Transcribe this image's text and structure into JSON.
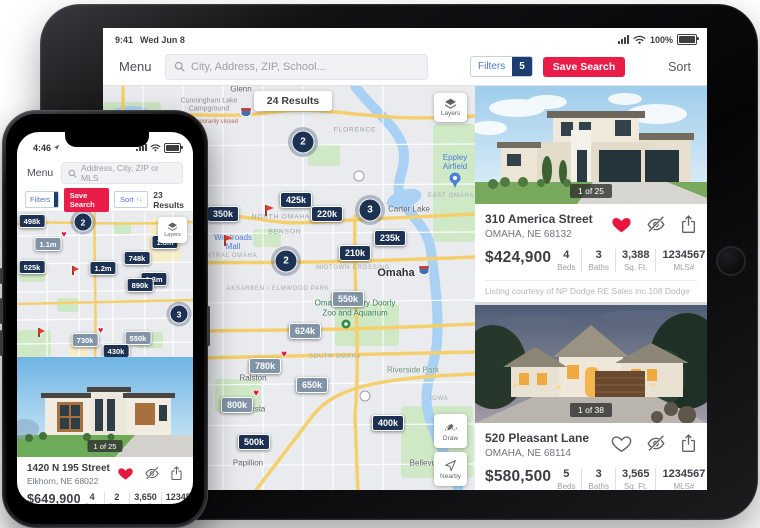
{
  "ipad": {
    "status": {
      "time": "9:41",
      "date": "Wed Jun 8",
      "battery": "100%"
    },
    "toolbar": {
      "menu": "Menu",
      "search_placeholder": "City, Address, ZIP, School...",
      "filters_label": "Filters",
      "filters_count": "5",
      "save_search_label": "Save Search",
      "sort_label": "Sort"
    },
    "map": {
      "results_badge": "24 Results",
      "layers_label": "Layers",
      "draw_label": "Draw",
      "nearby_label": "Nearby",
      "clusters": [
        {
          "count": "2",
          "x": 200,
          "y": 56
        },
        {
          "count": "3",
          "x": 267,
          "y": 124
        },
        {
          "count": "2",
          "x": 183,
          "y": 175
        }
      ],
      "pins": [
        {
          "value": "425k",
          "x": 193,
          "y": 114
        },
        {
          "value": "350k",
          "x": 120,
          "y": 128
        },
        {
          "value": "220k",
          "x": 224,
          "y": 128
        },
        {
          "value": "235k",
          "x": 287,
          "y": 152
        },
        {
          "value": "210k",
          "x": 252,
          "y": 167
        },
        {
          "value": "550k",
          "x": 245,
          "y": 213,
          "viewed": true
        },
        {
          "value": "624k",
          "x": 202,
          "y": 245,
          "viewed": true
        },
        {
          "value": "780k",
          "x": 162,
          "y": 280,
          "viewed": true,
          "heart": true
        },
        {
          "value": "650k",
          "x": 209,
          "y": 299,
          "viewed": true
        },
        {
          "value": "800k",
          "x": 134,
          "y": 319,
          "viewed": true,
          "heart": true
        },
        {
          "value": "400k",
          "x": 285,
          "y": 337
        },
        {
          "value": "500k",
          "x": 151,
          "y": 356
        }
      ],
      "flags": [
        {
          "x": 163,
          "y": 130
        },
        {
          "x": 122,
          "y": 160
        }
      ],
      "labels": [
        {
          "text": "Glenn",
          "type": "city-sm",
          "x": 138,
          "y": 3
        },
        {
          "text": "Cunningham Lake Campground",
          "type": "poi-gray",
          "x": 106,
          "y": 20
        },
        {
          "text": "Temporarily closed",
          "type": "note",
          "x": 110,
          "y": 36
        },
        {
          "text": "FLORENCE",
          "type": "area",
          "x": 252,
          "y": 44
        },
        {
          "text": "Eppley Airfield",
          "type": "poi-blue",
          "x": 352,
          "y": 76
        },
        {
          "text": "EAST OMAHA",
          "type": "area-sm",
          "x": 348,
          "y": 110
        },
        {
          "text": "Carter Lake",
          "type": "city-sm",
          "x": 306,
          "y": 123
        },
        {
          "text": "NORTH OMAHA",
          "type": "area",
          "x": 178,
          "y": 131
        },
        {
          "text": "BENSON",
          "type": "area",
          "x": 182,
          "y": 146
        },
        {
          "text": "Westroads Mall",
          "type": "poi-blue",
          "x": 130,
          "y": 156
        },
        {
          "text": "CENTRAL OMAHA",
          "type": "area-sm",
          "x": 124,
          "y": 170
        },
        {
          "text": "MIDTOWN CROSSING",
          "type": "area-sm",
          "x": 250,
          "y": 182
        },
        {
          "text": "Omaha",
          "type": "city",
          "x": 293,
          "y": 187
        },
        {
          "text": "AKSARBEN / ELMWOOD PARK",
          "type": "area-sm",
          "x": 175,
          "y": 203
        },
        {
          "text": "Omaha's Henry Doorly Zoo and Aquarium",
          "type": "poi-green",
          "x": 252,
          "y": 222
        },
        {
          "text": "SOUTH OMAHA",
          "type": "area-sm",
          "x": 232,
          "y": 271
        },
        {
          "text": "Riverside Park",
          "type": "park",
          "x": 310,
          "y": 284
        },
        {
          "text": "Ralston",
          "type": "city-sm",
          "x": 150,
          "y": 292
        },
        {
          "text": "IOWA",
          "type": "area-sm",
          "x": 336,
          "y": 313
        },
        {
          "text": "La Vista",
          "type": "city-sm",
          "x": 148,
          "y": 323
        },
        {
          "text": "Papillion",
          "type": "city-sm",
          "x": 145,
          "y": 377
        },
        {
          "text": "Bellevue",
          "type": "city-sm",
          "x": 322,
          "y": 377
        }
      ]
    },
    "cards": [
      {
        "counter": "1 of 25",
        "address": "310 America Street",
        "city": "OMAHA, NE 68132",
        "price": "$424,900",
        "stats": [
          {
            "value": "4",
            "label": "Beds"
          },
          {
            "value": "3",
            "label": "Baths"
          },
          {
            "value": "3,388",
            "label": "Sq. Ft."
          },
          {
            "value": "1234567",
            "label": "MLS#"
          }
        ],
        "courtesy": "Listing courtesy of NP Dodge RE Sales inc 108 Dodge",
        "favorited": true
      },
      {
        "counter": "1 of 38",
        "address": "520 Pleasant Lane",
        "city": "OMAHA, NE 68114",
        "price": "$580,500",
        "stats": [
          {
            "value": "5",
            "label": "Beds"
          },
          {
            "value": "3",
            "label": "Baths"
          },
          {
            "value": "3,565",
            "label": "Sq. Ft."
          },
          {
            "value": "1234567",
            "label": "MLS#"
          }
        ],
        "courtesy": "Listing courtesy of NP Dodge RE Sales inc 108 Dodge",
        "favorited": false
      }
    ]
  },
  "iphone": {
    "status": {
      "time": "4:46"
    },
    "toolbar": {
      "menu": "Menu",
      "search_placeholder": "Address, City, ZIP or MLS"
    },
    "filter_row": {
      "filters_label": "Filters",
      "filters_count": "5",
      "save_search_label": "Save Search",
      "sort_label": "Sort",
      "results": "23 Results"
    },
    "map": {
      "layers_label": "Layers",
      "clusters": [
        {
          "count": "2",
          "x": 66,
          "y": 10
        },
        {
          "count": "3",
          "x": 162,
          "y": 102
        }
      ],
      "pins": [
        {
          "value": "498k",
          "x": 15,
          "y": 9
        },
        {
          "value": "1.1m",
          "x": 31,
          "y": 32,
          "viewed": true,
          "heart": true
        },
        {
          "value": "1.8m",
          "x": 148,
          "y": 30
        },
        {
          "value": "748k",
          "x": 120,
          "y": 46
        },
        {
          "value": "525k",
          "x": 15,
          "y": 55
        },
        {
          "value": "1.2m",
          "x": 86,
          "y": 56
        },
        {
          "value": "1.3m",
          "x": 137,
          "y": 67
        },
        {
          "value": "890k",
          "x": 123,
          "y": 73
        },
        {
          "value": "730k",
          "x": 68,
          "y": 128,
          "viewed": true,
          "heart": true
        },
        {
          "value": "550k",
          "x": 121,
          "y": 126,
          "viewed": true
        },
        {
          "value": "430k",
          "x": 99,
          "y": 139
        }
      ],
      "flags": [
        {
          "x": 56,
          "y": 63
        },
        {
          "x": 22,
          "y": 125
        }
      ],
      "labels": []
    },
    "card": {
      "counter": "1 of 25",
      "address": "1420 N 195 Street",
      "city": "Elkhorn, NE 68022",
      "price": "$649,900",
      "stats": [
        {
          "value": "4",
          "label": "Beds"
        },
        {
          "value": "2",
          "label": "Baths"
        },
        {
          "value": "3,650",
          "label": "Sq. Ft."
        },
        {
          "value": "1234567",
          "label": "MLS#"
        }
      ],
      "courtesy": "Listing courtesy of NP Dodge RE Sales",
      "favorited": true
    }
  }
}
